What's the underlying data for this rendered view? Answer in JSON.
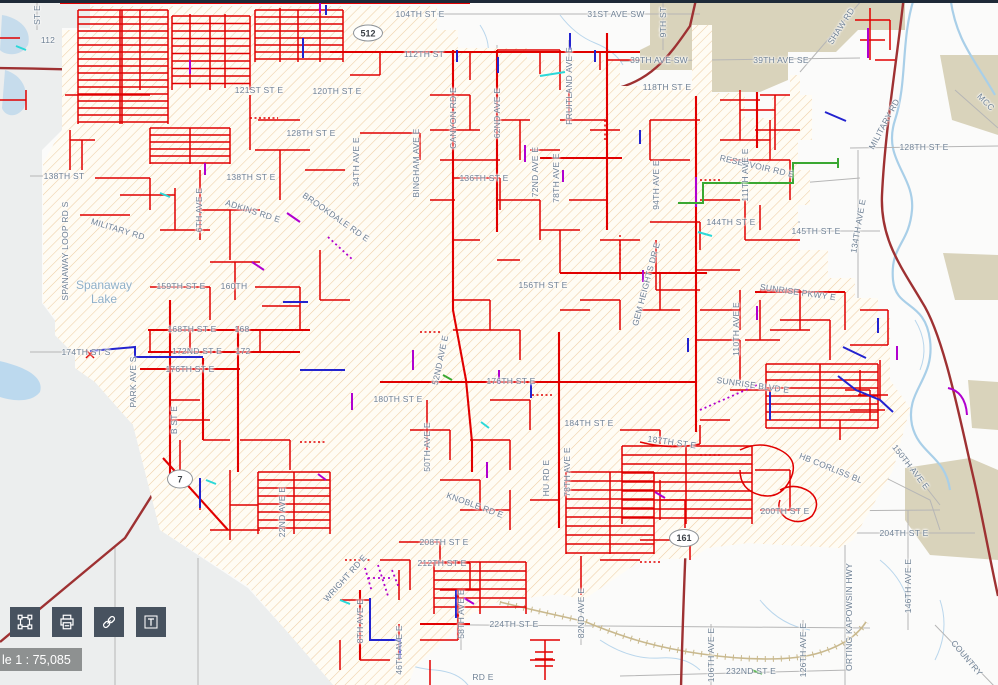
{
  "map": {
    "scale_label": "le 1 : 75,085",
    "lake_label_line1": "Spanaway",
    "lake_label_line2": "Lake",
    "lake_label_pos": {
      "x": 104,
      "y": 292
    },
    "shields": [
      {
        "label": "512",
        "x": 368,
        "y": 33,
        "w": 30,
        "h": 17
      },
      {
        "label": "7",
        "x": 180,
        "y": 479,
        "w": 26,
        "h": 19
      },
      {
        "label": "161",
        "x": 684,
        "y": 538,
        "w": 30,
        "h": 18
      }
    ],
    "street_labels": [
      {
        "t": "104TH ST E",
        "x": 420,
        "y": 14,
        "r": 0
      },
      {
        "t": "31ST AVE SW",
        "x": 616,
        "y": 14,
        "r": 0
      },
      {
        "t": "ST E",
        "x": 37,
        "y": 15,
        "r": -90
      },
      {
        "t": "112",
        "x": 48,
        "y": 40,
        "r": 0
      },
      {
        "t": "39TH AVE SW",
        "x": 659,
        "y": 60,
        "r": 0
      },
      {
        "t": "39TH AVE SE",
        "x": 781,
        "y": 60,
        "r": 0
      },
      {
        "t": "9TH ST",
        "x": 663,
        "y": 22,
        "r": -90
      },
      {
        "t": "SHAW RD",
        "x": 841,
        "y": 26,
        "r": -57
      },
      {
        "t": "112TH ST",
        "x": 424,
        "y": 54,
        "r": 0
      },
      {
        "t": "118TH ST E",
        "x": 667,
        "y": 87,
        "r": 0
      },
      {
        "t": "121ST ST E",
        "x": 259,
        "y": 90,
        "r": 0
      },
      {
        "t": "120TH ST E",
        "x": 337,
        "y": 91,
        "r": 0
      },
      {
        "t": "MILITARY RD",
        "x": 884,
        "y": 124,
        "r": -62
      },
      {
        "t": "MCC",
        "x": 986,
        "y": 102,
        "r": 45
      },
      {
        "t": "128TH ST E",
        "x": 311,
        "y": 133,
        "r": 0
      },
      {
        "t": "128TH ST E",
        "x": 924,
        "y": 147,
        "r": 0
      },
      {
        "t": "FRUITLAND AVE E",
        "x": 569,
        "y": 86,
        "r": -90
      },
      {
        "t": "CANYON RD E",
        "x": 453,
        "y": 118,
        "r": -90
      },
      {
        "t": "62ND AVE E",
        "x": 497,
        "y": 113,
        "r": -90
      },
      {
        "t": "72ND AVE E",
        "x": 535,
        "y": 172,
        "r": -90
      },
      {
        "t": "78TH AVE E",
        "x": 556,
        "y": 178,
        "r": -90
      },
      {
        "t": "138TH ST",
        "x": 64,
        "y": 176,
        "r": 0
      },
      {
        "t": "138TH ST E",
        "x": 251,
        "y": 177,
        "r": 0
      },
      {
        "t": "136TH ST E",
        "x": 484,
        "y": 178,
        "r": 0
      },
      {
        "t": "6TH AVE E",
        "x": 199,
        "y": 210,
        "r": -90
      },
      {
        "t": "ADKINS RD E",
        "x": 253,
        "y": 211,
        "r": 18
      },
      {
        "t": "BROOKDALE RD E",
        "x": 336,
        "y": 217,
        "r": 35
      },
      {
        "t": "MILITARY RD",
        "x": 118,
        "y": 229,
        "r": 17
      },
      {
        "t": "SPANAWAY LOOP RD S",
        "x": 65,
        "y": 251,
        "r": -90
      },
      {
        "t": "144TH ST E",
        "x": 731,
        "y": 222,
        "r": 0
      },
      {
        "t": "145TH ST E",
        "x": 816,
        "y": 231,
        "r": 0
      },
      {
        "t": "RESERVOIR RD E",
        "x": 757,
        "y": 166,
        "r": 13
      },
      {
        "t": "94TH AVE E",
        "x": 656,
        "y": 185,
        "r": -90
      },
      {
        "t": "111TH AVE E",
        "x": 745,
        "y": 175,
        "r": -90
      },
      {
        "t": "134TH AVE E",
        "x": 858,
        "y": 226,
        "r": -80
      },
      {
        "t": "GEM HEIGHTS DR E",
        "x": 646,
        "y": 284,
        "r": -75
      },
      {
        "t": "156TH ST E",
        "x": 543,
        "y": 285,
        "r": 0
      },
      {
        "t": "159TH ST E",
        "x": 181,
        "y": 286,
        "r": 0
      },
      {
        "t": "160TH",
        "x": 234,
        "y": 286,
        "r": 0
      },
      {
        "t": "SUNRISE PKWY E",
        "x": 798,
        "y": 292,
        "r": 8
      },
      {
        "t": "110TH AVE E",
        "x": 736,
        "y": 329,
        "r": -90
      },
      {
        "t": "168TH ST E",
        "x": 192,
        "y": 329,
        "r": 0
      },
      {
        "t": "168",
        "x": 242,
        "y": 329,
        "r": 0
      },
      {
        "t": "172ND ST E",
        "x": 197,
        "y": 351,
        "r": 0
      },
      {
        "t": "172",
        "x": 243,
        "y": 351,
        "r": 0
      },
      {
        "t": "174TH ST S",
        "x": 86,
        "y": 352,
        "r": 0
      },
      {
        "t": "176TH ST E",
        "x": 190,
        "y": 369,
        "r": 0
      },
      {
        "t": "PARK AVE S",
        "x": 133,
        "y": 382,
        "r": -90
      },
      {
        "t": "B ST E",
        "x": 174,
        "y": 420,
        "r": -90
      },
      {
        "t": "34TH AVE E",
        "x": 356,
        "y": 162,
        "r": -90
      },
      {
        "t": "BINGHAM AVE E",
        "x": 416,
        "y": 163,
        "r": -90
      },
      {
        "t": "52ND AVE E",
        "x": 440,
        "y": 360,
        "r": -78
      },
      {
        "t": "176TH ST E",
        "x": 511,
        "y": 381,
        "r": 0
      },
      {
        "t": "180TH ST E",
        "x": 398,
        "y": 399,
        "r": 0
      },
      {
        "t": "50TH AVE E",
        "x": 427,
        "y": 447,
        "r": -90
      },
      {
        "t": "184TH ST E",
        "x": 589,
        "y": 423,
        "r": 0
      },
      {
        "t": "187TH ST E",
        "x": 672,
        "y": 442,
        "r": 8
      },
      {
        "t": "SUNRISE BLVD E",
        "x": 753,
        "y": 385,
        "r": 8
      },
      {
        "t": "HB CORLISS BL",
        "x": 831,
        "y": 468,
        "r": 22
      },
      {
        "t": "150TH AVE E",
        "x": 911,
        "y": 467,
        "r": 52
      },
      {
        "t": "KNOBLE RD E",
        "x": 475,
        "y": 505,
        "r": 20
      },
      {
        "t": "HU RD E",
        "x": 546,
        "y": 478,
        "r": -90
      },
      {
        "t": "78TH AVE E",
        "x": 567,
        "y": 472,
        "r": -90
      },
      {
        "t": "WRIGHT RD E",
        "x": 345,
        "y": 578,
        "r": -48
      },
      {
        "t": "22ND AVE E",
        "x": 282,
        "y": 512,
        "r": -90
      },
      {
        "t": "8TH AVE E",
        "x": 360,
        "y": 621,
        "r": -90
      },
      {
        "t": "46TH AVE E",
        "x": 399,
        "y": 650,
        "r": -90
      },
      {
        "t": "58TH AVE E",
        "x": 461,
        "y": 614,
        "r": -90
      },
      {
        "t": "82ND AVE E",
        "x": 581,
        "y": 613,
        "r": -90
      },
      {
        "t": "208TH ST E",
        "x": 444,
        "y": 542,
        "r": 0
      },
      {
        "t": "212TH ST E",
        "x": 442,
        "y": 563,
        "r": 0
      },
      {
        "t": "200TH ST E",
        "x": 785,
        "y": 511,
        "r": 0
      },
      {
        "t": "204TH ST E",
        "x": 904,
        "y": 533,
        "r": 0
      },
      {
        "t": "224TH ST E",
        "x": 514,
        "y": 624,
        "r": 0
      },
      {
        "t": "106TH AVE E",
        "x": 711,
        "y": 655,
        "r": -90
      },
      {
        "t": "126TH AVE E",
        "x": 803,
        "y": 650,
        "r": -90
      },
      {
        "t": "146TH AVE E",
        "x": 908,
        "y": 586,
        "r": -90
      },
      {
        "t": "ORTING KAPOWSIN HWY",
        "x": 849,
        "y": 617,
        "r": -90
      },
      {
        "t": "232ND ST E",
        "x": 751,
        "y": 671,
        "r": 0
      },
      {
        "t": "COUNTRY",
        "x": 967,
        "y": 658,
        "r": 50
      },
      {
        "t": "RD E",
        "x": 483,
        "y": 677,
        "r": 0
      }
    ],
    "utility_colors": {
      "distribution_red": "#e10000",
      "blue": "#2323cf",
      "purple": "#b100cf",
      "green": "#3aa832",
      "cyan": "#2bd8d8",
      "boundary_orange": "#e8a858",
      "highway_maroon": "#9e3132"
    }
  },
  "toolbar": {
    "buttons": [
      {
        "id": "extent",
        "icon": "extent-icon"
      },
      {
        "id": "print",
        "icon": "printer-icon"
      },
      {
        "id": "link",
        "icon": "link-icon"
      },
      {
        "id": "text",
        "icon": "text-icon"
      }
    ]
  }
}
